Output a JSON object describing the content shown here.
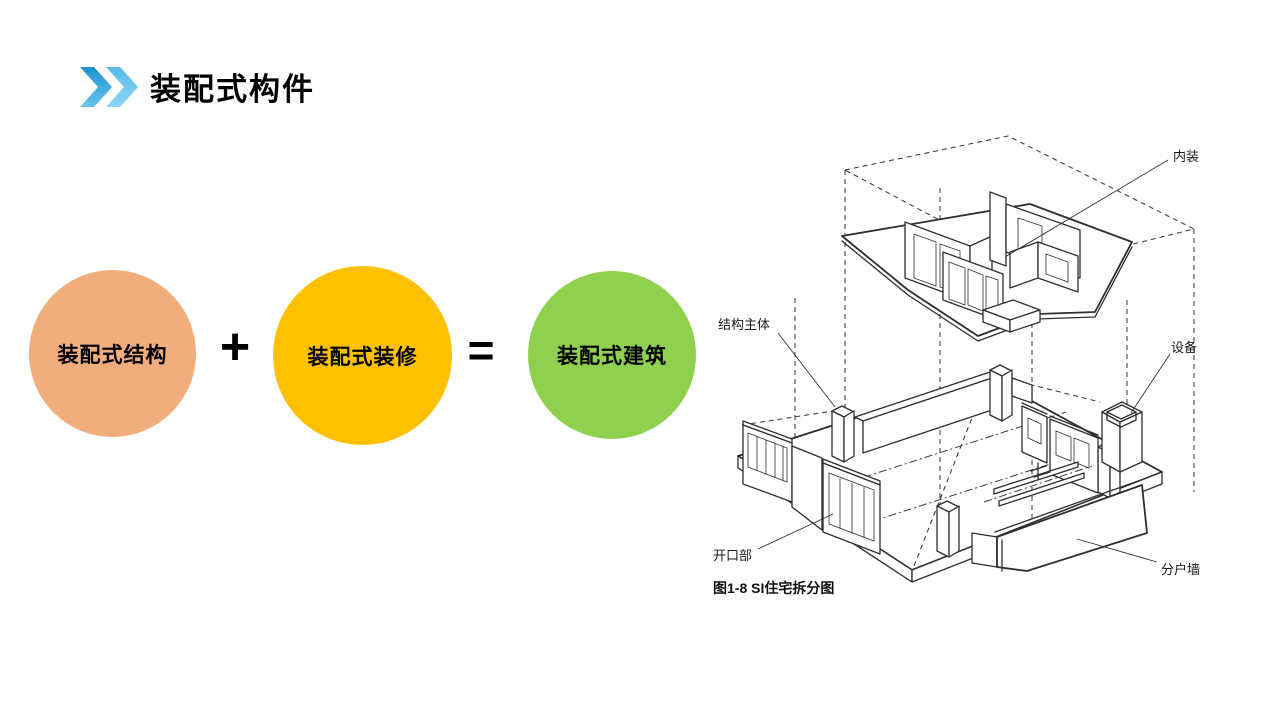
{
  "title": "装配式构件",
  "formula": {
    "items": [
      {
        "label": "装配式结构",
        "color": "#F2AD7D"
      },
      {
        "label": "装配式装修",
        "color": "#FFC000"
      },
      {
        "label": "装配式建筑",
        "color": "#8FD14F"
      }
    ],
    "plus": "+",
    "equals": "="
  },
  "figure": {
    "labels": {
      "interior": "内装",
      "structure": "结构主体",
      "equipment": "设备",
      "opening": "开口部",
      "party_wall": "分户墙"
    },
    "caption": "图1-8  SI住宅拆分图"
  },
  "accent": {
    "chevron_blue_dark": "#1E8FD0",
    "chevron_blue_light": "#8ED5F5"
  }
}
